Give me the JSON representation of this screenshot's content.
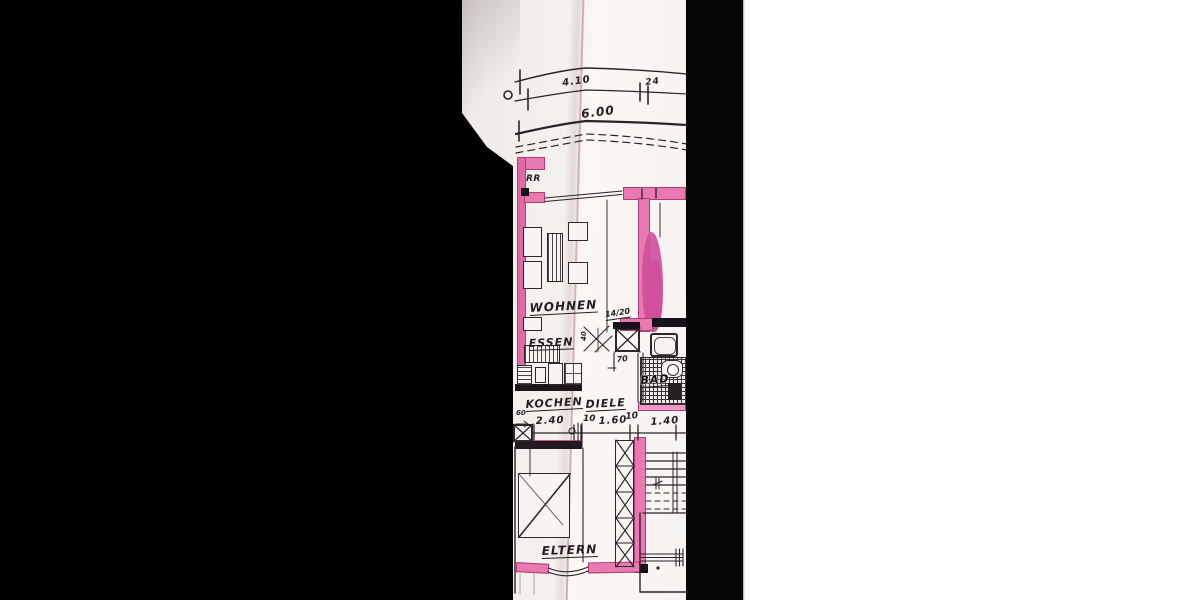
{
  "plan": {
    "marks": {
      "rr": "RR"
    },
    "rooms": {
      "wohnen": "WOHNEN",
      "essen": "ESSEN",
      "kochen": "KOCHEN",
      "diele": "DIELE",
      "bad": "BAD",
      "eltern": "ELTERN"
    },
    "dims": {
      "top_width": "4.10",
      "top_offset": "24",
      "total_width": "6.00",
      "door": "14/20",
      "door_clear": "40",
      "seventy": "70",
      "sixty": "60",
      "row": [
        "2.40",
        "10",
        "1.60",
        "10",
        "1.40"
      ]
    },
    "colors": {
      "wall_pink": "#e87ab1",
      "wall_edge": "#b03d7c",
      "highlight": "#cf4f9b",
      "ink": "#2a2428",
      "paper": "#f3efec",
      "mask": "#000000",
      "margin": "#ffffff"
    }
  }
}
